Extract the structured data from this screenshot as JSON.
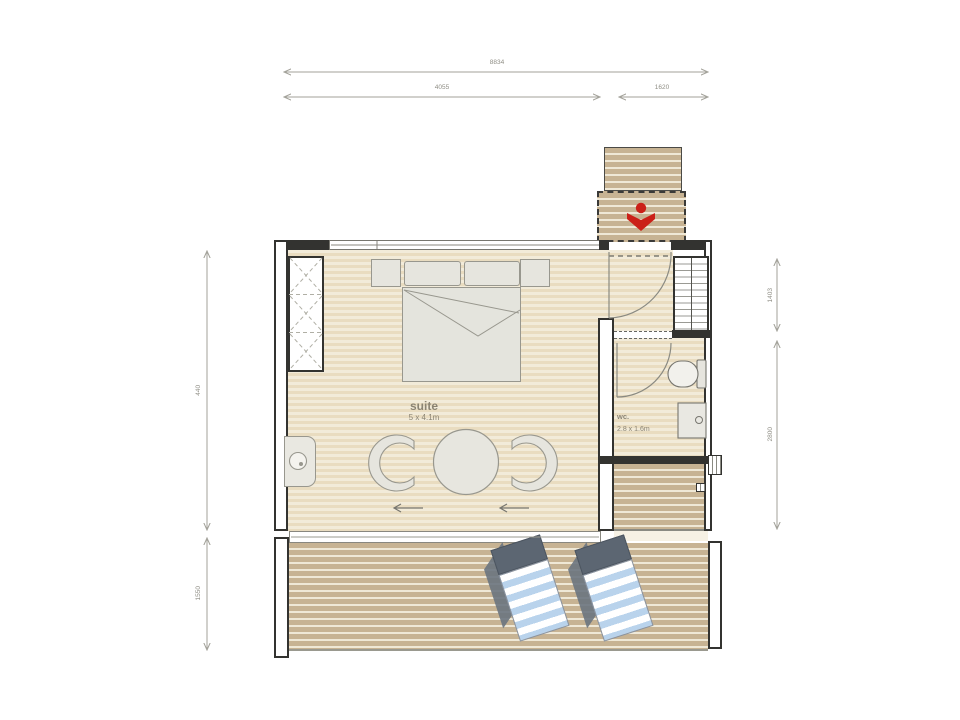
{
  "plan": {
    "dimensions": {
      "top_total": "8834",
      "top_left": "4055",
      "top_right": "1620",
      "left_upper": "440",
      "left_lower": "1550",
      "right_upper": "1403",
      "right_lower": "2800"
    },
    "rooms": {
      "suite": {
        "label": "suite",
        "size": "5 x 4.1m"
      },
      "wc": {
        "label": "wc.",
        "size": "2.8 x 1.6m"
      }
    },
    "icons": {
      "entrance": "entrance-arrow-icon"
    },
    "colors": {
      "accent_red": "#cb2018",
      "wall": "#333330",
      "floor_light": "#eee3c9",
      "deck_wood": "#c7b393",
      "lounger_blue": "#b9d3ec",
      "furniture_fill": "#e6e5de"
    }
  }
}
